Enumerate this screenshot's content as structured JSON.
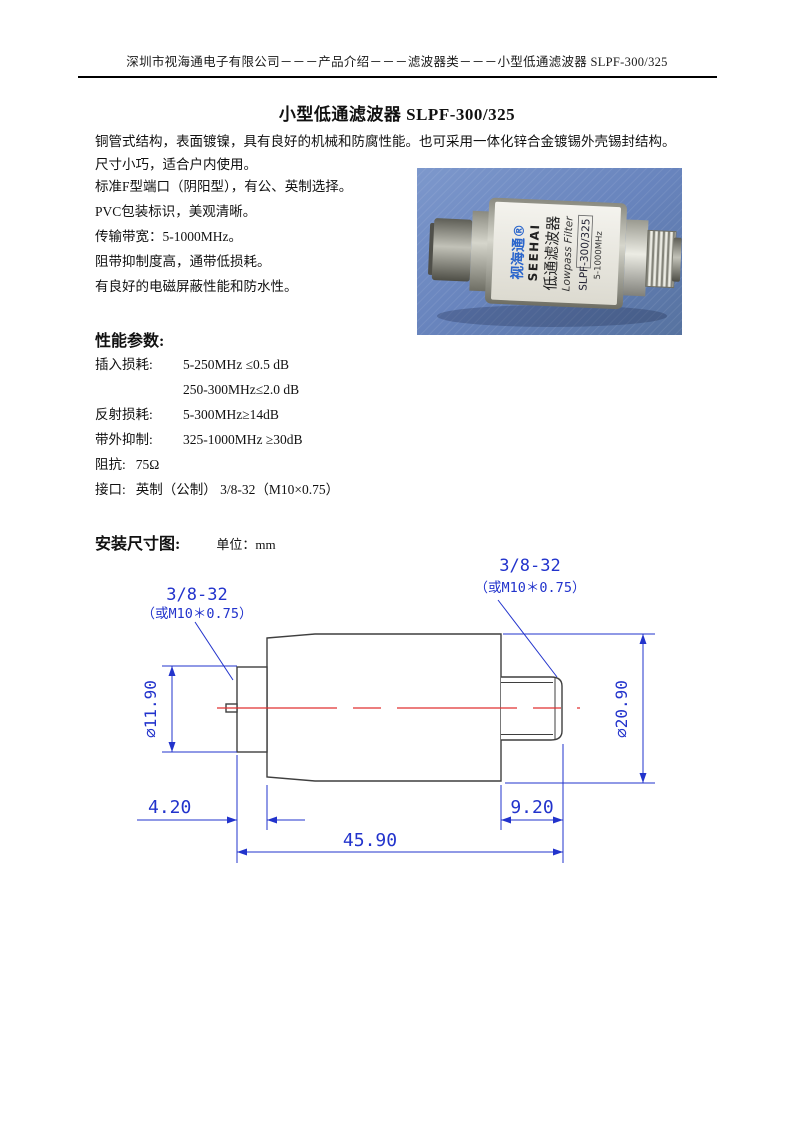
{
  "header": {
    "text": "深圳市视海通电子有限公司－－－产品介绍－－－滤波器类－－－小型低通滤波器 SLPF-300/325"
  },
  "title": "小型低通滤波器 SLPF-300/325",
  "intro": {
    "lines": [
      "铜管式结构，表面镀镍，具有良好的机械和防腐性能。也可采用一体化锌合金镀锡外壳锡封结构。",
      "尺寸小巧，适合户内使用。"
    ]
  },
  "features": [
    "标准F型端口（阴阳型），有公、英制选择。",
    "PVC包装标识，美观清晰。",
    "传输带宽：5-1000MHz。",
    "阻带抑制度高，通带低损耗。",
    "有良好的电磁屏蔽性能和防水性。"
  ],
  "performance": {
    "heading": "性能参数:",
    "rows": [
      {
        "label": "插入损耗:",
        "value": "5-250MHz ≤0.5 dB"
      },
      {
        "label": "",
        "value": "250-300MHz≤2.0 dB"
      },
      {
        "label": "反射损耗:",
        "value": "5-300MHz≥14dB"
      },
      {
        "label": "带外抑制:",
        "value": "325-1000MHz ≥30dB"
      }
    ],
    "inline_rows": [
      {
        "label": "阻抗:",
        "value": "75Ω"
      },
      {
        "label": "接口:",
        "value": "英制（公制） 3/8-32（M10×0.75）"
      }
    ]
  },
  "installation": {
    "heading": "安装尺寸图:",
    "unit": "单位：mm"
  },
  "drawing": {
    "thread_left_line1": "3/8-32",
    "thread_left_line2": "（或M10＊0.75）",
    "thread_right_line1": "3/8-32",
    "thread_right_line2": "（或M10＊0.75）",
    "dia_small": "∅11.90",
    "dia_large": "∅20.90",
    "len_left": "4.20",
    "len_right": "9.20",
    "len_total": "45.90",
    "colors": {
      "dimension": "#2233cc",
      "outline": "#3f3f3f",
      "centerline": "#e03030"
    }
  },
  "photo": {
    "label_lines": [
      "视海通®",
      "SEEHAI",
      "低通滤波器",
      "Lowpass Filter",
      "SLPF-300/325",
      "5-1000MHz"
    ],
    "colors": {
      "background_blue": "#6884bd",
      "brand_blue": "#2b66cc",
      "label_white": "#efeee8"
    }
  }
}
